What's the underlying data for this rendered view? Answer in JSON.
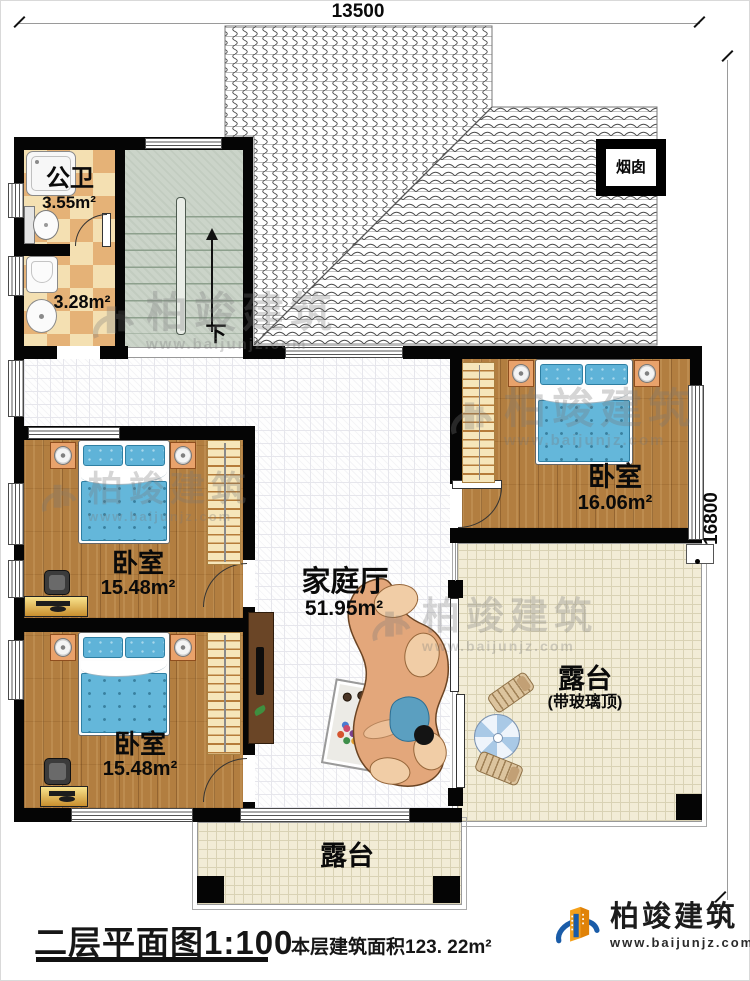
{
  "plan": {
    "dim_top": "13500",
    "dim_right": "16800",
    "rooms": {
      "bathroom": {
        "name": "公卫",
        "area": "3.55m²"
      },
      "laundry": {
        "area": "3.28m²"
      },
      "stairs": {
        "direction": "下"
      },
      "bedroom_mid": {
        "name": "卧室",
        "area": "15.48m²"
      },
      "bedroom_bottom": {
        "name": "卧室",
        "area": "15.48m²"
      },
      "bedroom_right": {
        "name": "卧室",
        "area": "16.06m²"
      },
      "family_hall": {
        "name": "家庭厅",
        "area": "51.95m²"
      },
      "terrace_right": {
        "name": "露台",
        "note": "(带玻璃顶)"
      },
      "terrace_bottom": {
        "name": "露台"
      },
      "chimney": {
        "name": "烟囱"
      }
    }
  },
  "watermark": {
    "name": "柏竣建筑",
    "url": "www.baijunjz.com"
  },
  "footer": {
    "title": "二层平面图1:100",
    "floor_area": "本层建筑面积123. 22m²",
    "brand": "柏竣建筑",
    "website": "www.baijunjz.com"
  },
  "colors": {
    "wall": "#050505",
    "wood_floor": "#b27e40",
    "bedding_blue": "#64b7da",
    "tile_light": "#f4e0b2",
    "tile_dark": "#e5b277",
    "terrace_floor": "#f2ecd6",
    "stair_floor": "#cbd4c9",
    "sofa_tan": "#e3a77b",
    "brand_blue": "#1a5ca8",
    "brand_orange": "#f5a01a"
  }
}
